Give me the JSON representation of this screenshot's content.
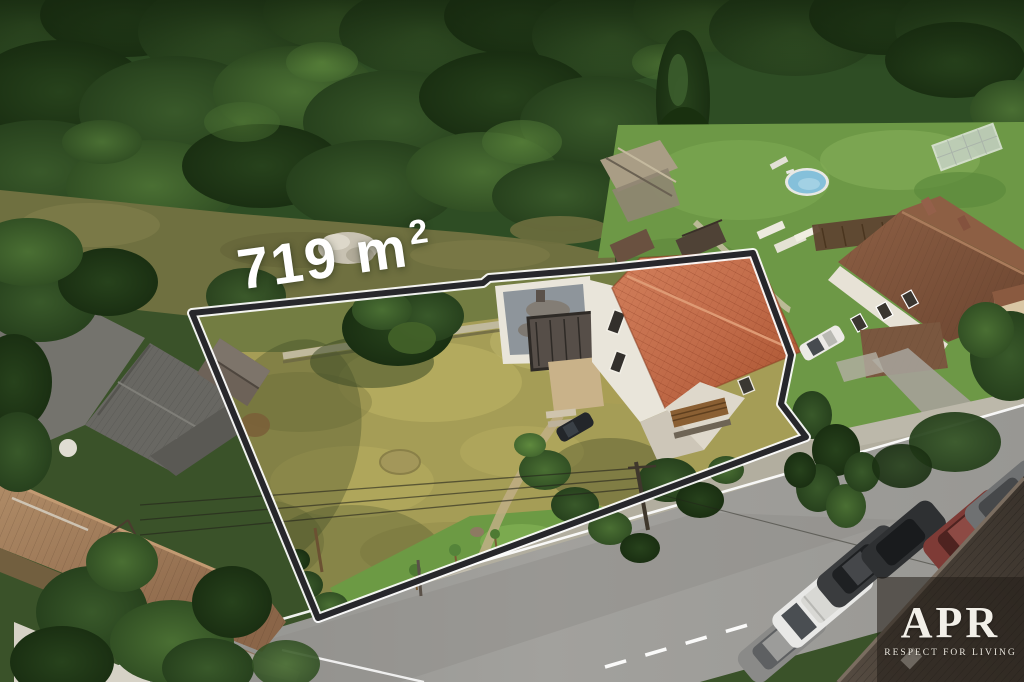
{
  "image": {
    "type": "aerial-property-listing-photo",
    "area_label": {
      "main": "719 m",
      "superscript": "2"
    },
    "watermark": {
      "brand": "APR",
      "tagline": "RESPECT FOR LIVING"
    },
    "colors": {
      "outline_dark": "#27272b",
      "outline_light": "#ffffff",
      "label_text": "#ffffff",
      "red_roof": "#c06a48",
      "barn_roof": "#9c7a58",
      "neighbor_roof": "#7d5139",
      "dark_roof": "#4a4139",
      "pool_water": "#85c0da",
      "road": "#9b9a96",
      "dry_grass": "#a59d56",
      "lawn_green": "#6d9846",
      "forest_green": "#2e4d24",
      "watermark_bg": "rgba(33,27,21,0.55)"
    }
  }
}
